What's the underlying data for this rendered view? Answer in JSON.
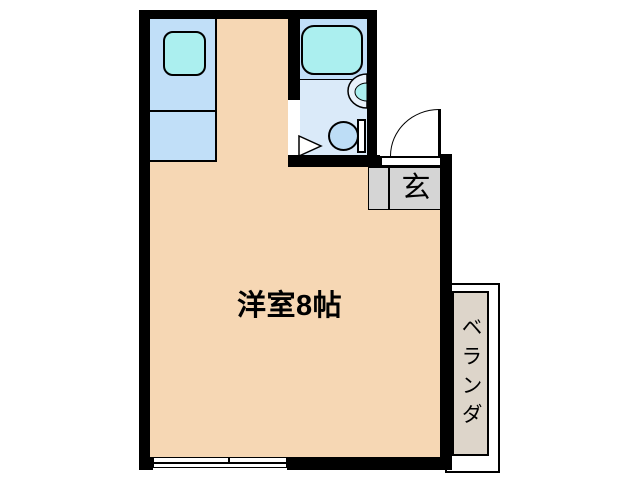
{
  "floorplan": {
    "main_room": {
      "label": "洋室8帖"
    },
    "entrance": {
      "label": "玄"
    },
    "balcony": {
      "label": "ベランダ"
    },
    "fixtures": {
      "kitchen_sink": "kitchen-sink",
      "bathtub": "bathtub",
      "wash_basin": "wash-basin",
      "toilet": "toilet",
      "entrance_door": "entrance-door-swing",
      "bathroom_door": "bathroom-door-swing",
      "window": "sliding-window"
    },
    "colors": {
      "wall": "#000000",
      "room_floor": "#F6D7B4",
      "counter_blue": "#C1DFF8",
      "fixture_cyan": "#ABEFEF",
      "bathroom_floor": "#DAEAF9",
      "toilet_blue": "#BDDDF6",
      "entrance_gray": "#D5D5D5",
      "balcony_beige": "#DDD5CA"
    }
  }
}
